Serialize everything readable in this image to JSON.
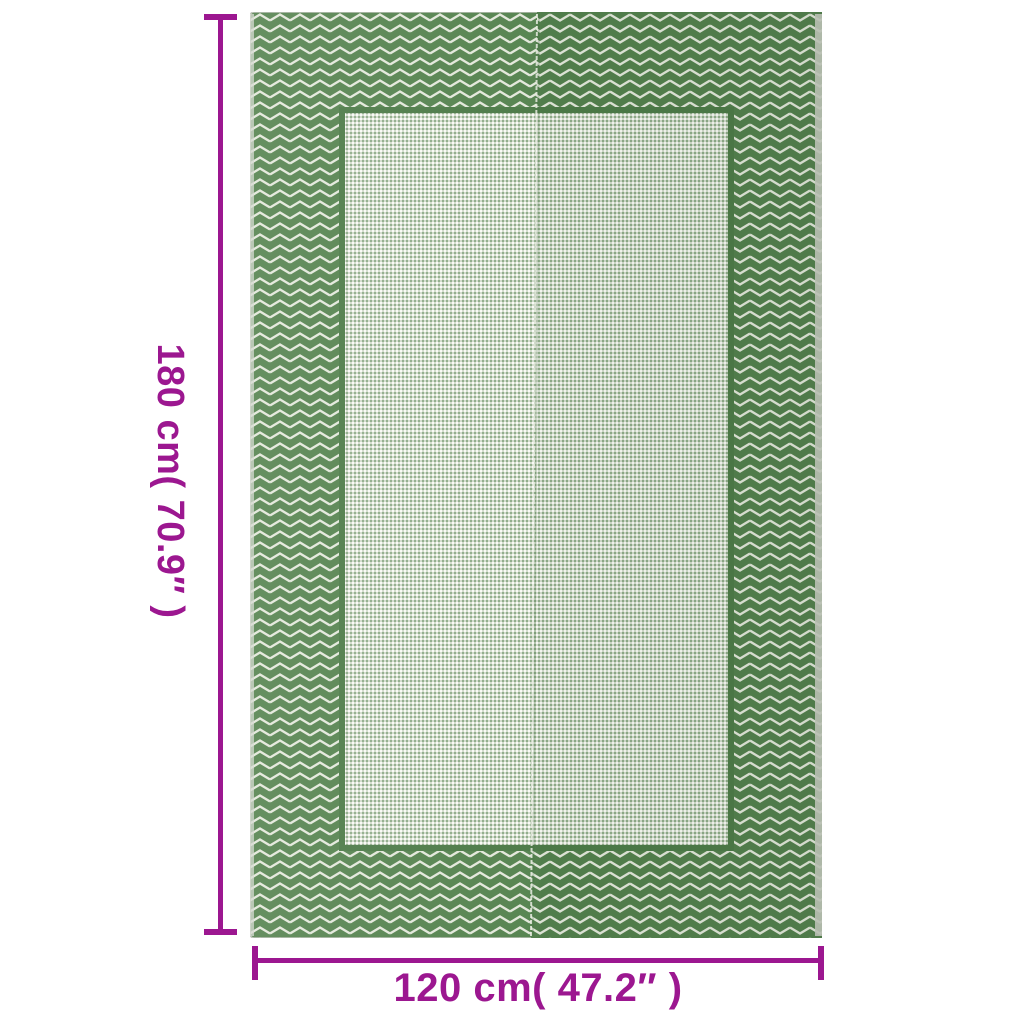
{
  "diagram": {
    "kind": "product-dimension-diagram",
    "product": "green chevron woven rug",
    "accent_color": "#9C1790",
    "height_dimension": {
      "label": "180 cm( 70.9″ )"
    },
    "width_dimension": {
      "label": "120 cm( 47.2″ )"
    },
    "rug_colors": {
      "border_green": "#55834F",
      "chevron_line": "#E3E8DB",
      "inner_frame_green": "#4C7A47",
      "field_light_sage": "#D3DCCD",
      "field_dot_green": "#8FAC89",
      "field_dot_white": "#FAFBF6",
      "selvage_gray": "#C6CBC0"
    }
  }
}
